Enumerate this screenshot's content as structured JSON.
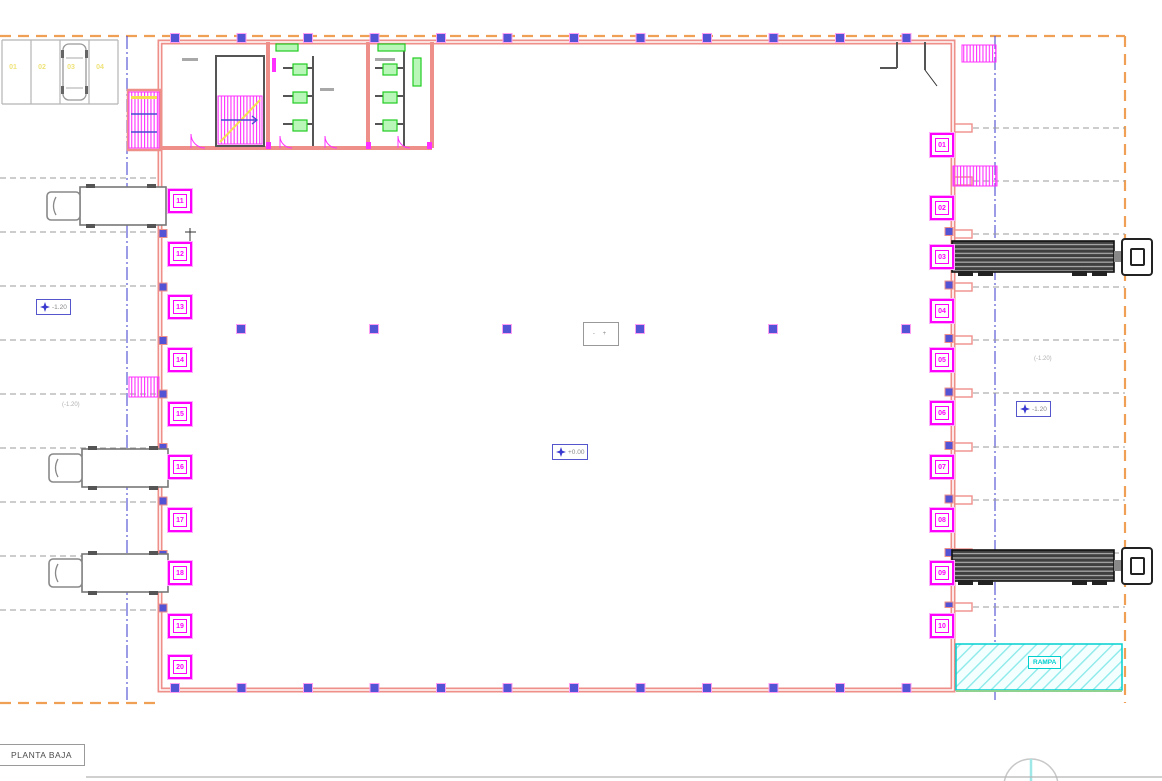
{
  "drawing": {
    "title": "PLANTA BAJA",
    "ramp_label": "RAMPA",
    "level_markers": {
      "center": "+0.00",
      "left": "-1.20",
      "right": "-1.20"
    },
    "notes": {
      "left": "(-1.20)",
      "right": "(-1.20)",
      "center_tag": "- +"
    },
    "docks_left": [
      "11",
      "12",
      "13",
      "14",
      "15",
      "16",
      "17",
      "18",
      "19",
      "20"
    ],
    "docks_right": [
      "01",
      "02",
      "03",
      "04",
      "05",
      "06",
      "07",
      "08",
      "09",
      "10"
    ],
    "parking_stalls": [
      "01",
      "02",
      "03",
      "04"
    ],
    "colors": {
      "wall": "#ef8f8a",
      "annotation_magenta": "#ff00ff",
      "axis_blue": "#4a4ad2",
      "boundary_orange": "#f0a055",
      "ramp_cyan": "#00cfcf",
      "parking_yellow": "#efe37a",
      "fixture_green": "#22cc22"
    }
  }
}
